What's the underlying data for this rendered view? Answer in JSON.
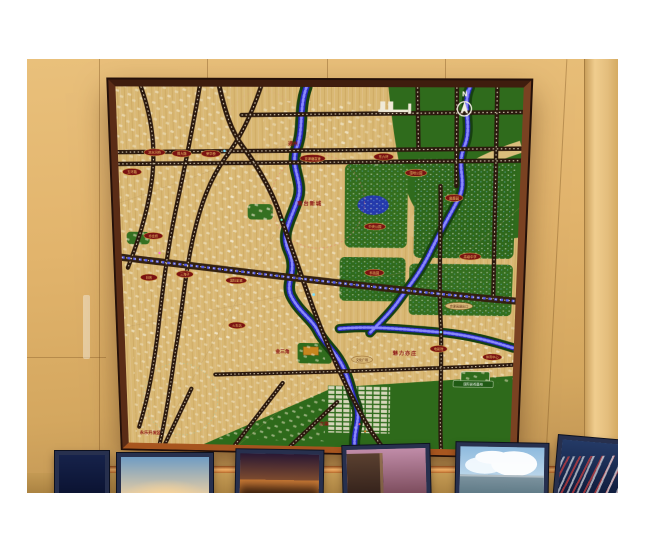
{
  "photo": {
    "compass": "N"
  },
  "labels": {
    "red": [
      "通州",
      "南台新城",
      "金三角",
      "魅力亦庄",
      "次渠",
      "永乐开发区"
    ],
    "ovals": [
      "凉水河桥",
      "博大路",
      "荣华桥",
      "五环路",
      "京津塘高速",
      "东六环",
      "亦庄桥",
      "旧宫",
      "国际影城",
      "三海子",
      "湿地公园",
      "麋鹿园",
      "中央公园",
      "高级中学",
      "科技园",
      "电影院",
      "体育中心",
      "火车站"
    ],
    "tan": [
      "京津高速出口",
      "文化广场"
    ],
    "signs": [
      "国际影视基地"
    ]
  },
  "posters": [
    {
      "name": "night-waterfront",
      "top": "#16224a",
      "bottom": "#0a1230"
    },
    {
      "name": "sunset-horizon",
      "top": "#6f9cc4",
      "bottom": "#eccfa2"
    },
    {
      "name": "city-night-panorama",
      "top": "#2a1833",
      "bottom": "#b06a2c"
    },
    {
      "name": "dusk-street",
      "top": "#c08ca8",
      "bottom": "#7a4a5a"
    },
    {
      "name": "sky-skyline",
      "top": "#8ebade",
      "bottom": "#d8e8f2"
    },
    {
      "name": "highway-light-trails",
      "top": "#243a66",
      "bottom": "#0e1a3a"
    }
  ],
  "colors": {
    "wall": "#ddb06a",
    "frame_wood": "#5a2c16",
    "map_base": "#dcbc78",
    "river_water": "#2828c0",
    "river_led": "#8e8eff",
    "road": "#2a180d",
    "green": "#2f6b1c",
    "label_oval": "#7a1212",
    "label_gold": "#eec86a",
    "label_red_text": "#8c1616"
  }
}
